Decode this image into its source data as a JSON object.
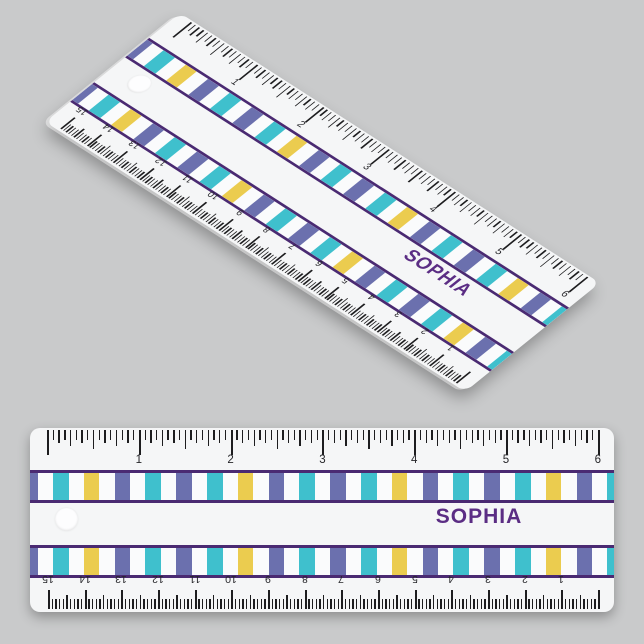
{
  "page": {
    "background_color": "#c9cacb"
  },
  "ruler": {
    "personalized_name": "SOPHIA",
    "inch_scale_numbers": [
      "1",
      "2",
      "3",
      "4",
      "5",
      "6"
    ],
    "cm_scale_numbers": [
      "15",
      "14",
      "13",
      "12",
      "11",
      "10",
      "9",
      "8",
      "7",
      "6",
      "5",
      "4",
      "3",
      "2",
      "1"
    ],
    "stripe_pattern": [
      "slate",
      "teal",
      "yellow",
      "slate",
      "teal"
    ],
    "colors": {
      "body": "#f5f6f7",
      "tick": "#1d1d1f",
      "band_border": "#4a2a72",
      "slate": "#6b70ae",
      "teal": "#3fc0cd",
      "yellow": "#ebcc4f",
      "name_text": "#5b2d84"
    }
  }
}
